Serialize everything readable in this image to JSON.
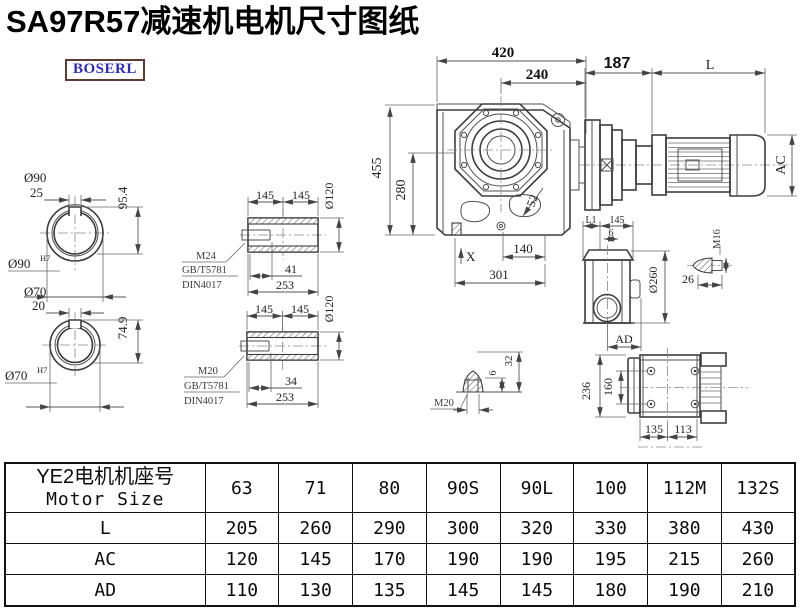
{
  "title": "SA97R57减速机电机尺寸图纸",
  "brand": {
    "logo_text": "BOSERL"
  },
  "drawing": {
    "shaft_large": {
      "dia_label": "Ø90",
      "key_width": "25",
      "height": "95.4",
      "fit_dia": "Ø90",
      "fit_tol": "H7"
    },
    "shaft_small": {
      "dia_label": "Ø70",
      "key_width": "20",
      "height": "74.9",
      "fit_dia": "Ø70",
      "fit_tol": "H7"
    },
    "bushing_top": {
      "len_left": "145",
      "len_right": "145",
      "outer_dia": "Ø120",
      "thread": "M24",
      "std_gb": "GB/T5781",
      "std_din": "DIN4017",
      "thread_len": "41",
      "total_len": "253"
    },
    "bushing_bottom": {
      "len_left": "145",
      "len_right": "145",
      "outer_dia": "Ø120",
      "thread": "M20",
      "std_gb": "GB/T5781",
      "std_din": "DIN4017",
      "thread_len": "34",
      "total_len": "253"
    },
    "front_view": {
      "overall_width": "420",
      "center_to_right": "240",
      "overall_height": "455",
      "center_height": "280",
      "bolt_dim": "52",
      "foot_center": "140",
      "foot_width": "301",
      "oil_mark": "X"
    },
    "motor_view": {
      "adapter_len": "187",
      "motor_len": "L",
      "motor_dia": "AC"
    },
    "side_view": {
      "l1": "L1",
      "seg": "145",
      "offset": "6",
      "flange_dia": "Ø260",
      "ad": "AD"
    },
    "bolt": {
      "thread": "M16",
      "len": "26"
    },
    "plug": {
      "thread": "M20",
      "h_small": "6",
      "h_large": "32"
    },
    "top_view": {
      "height_overall": "236",
      "height_inner": "160",
      "width_left": "135",
      "width_right": "113"
    }
  },
  "table": {
    "header_cn": "YE2电机机座号",
    "header_en": "Motor Size",
    "frame_sizes": [
      "63",
      "71",
      "80",
      "90S",
      "90L",
      "100",
      "112M",
      "132S"
    ],
    "rows": [
      {
        "label": "L",
        "values": [
          "205",
          "260",
          "290",
          "300",
          "320",
          "330",
          "380",
          "430"
        ]
      },
      {
        "label": "AC",
        "values": [
          "120",
          "145",
          "170",
          "190",
          "190",
          "195",
          "215",
          "260"
        ]
      },
      {
        "label": "AD",
        "values": [
          "110",
          "130",
          "135",
          "145",
          "145",
          "180",
          "190",
          "210"
        ]
      }
    ]
  }
}
